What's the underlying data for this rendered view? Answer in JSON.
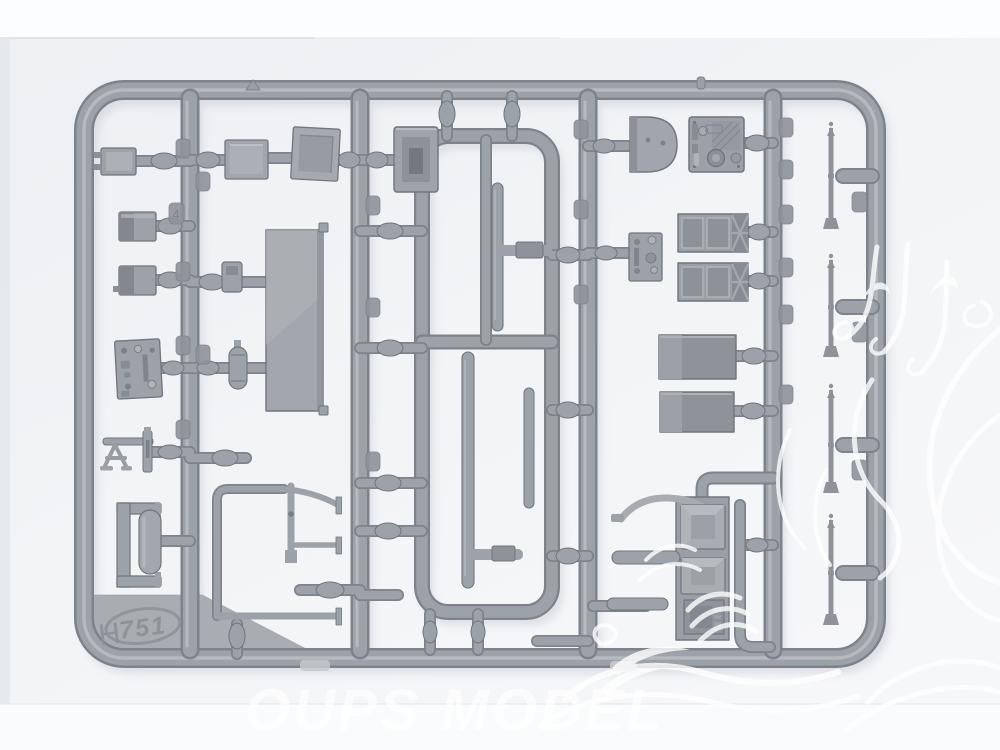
{
  "photo": {
    "subject": "grey injection-molded plastic model kit sprue photographed on a white backdrop",
    "plastic_color_name": "grey",
    "colors": {
      "backdrop": "#f0f2f4",
      "paper_white": "#fcfdfe",
      "tube_mid": "#9da1a8",
      "tube_dark": "#7e828a",
      "tube_hi": "#c6c9cd",
      "part_edge": "#71757c",
      "shadow": "#c9cbd1",
      "watermark_white": "#ffffff"
    },
    "parts": [
      "small box with prongs",
      "battery box",
      "battery box",
      "firewall detail plate",
      "trestle stand",
      "bracket with tank",
      "square box",
      "rimmed square plate",
      "large flat panel",
      "muffler cylinder",
      "door frame with hinges",
      "slotted box",
      "long thin rod",
      "long thin rod",
      "d-shaped cover",
      "instrument panel",
      "small detail plate",
      "radiator block",
      "radiator block",
      "storage box",
      "storage box",
      "seat assembly with grab handle",
      "thin pointed rod",
      "thin pointed rod",
      "thin pointed rod",
      "thin pointed rod"
    ]
  },
  "markings": {
    "mold_letter": "H",
    "mold_number": "751",
    "part_number_tab": "4"
  },
  "watermark": {
    "text": "OUPS MODEL"
  }
}
